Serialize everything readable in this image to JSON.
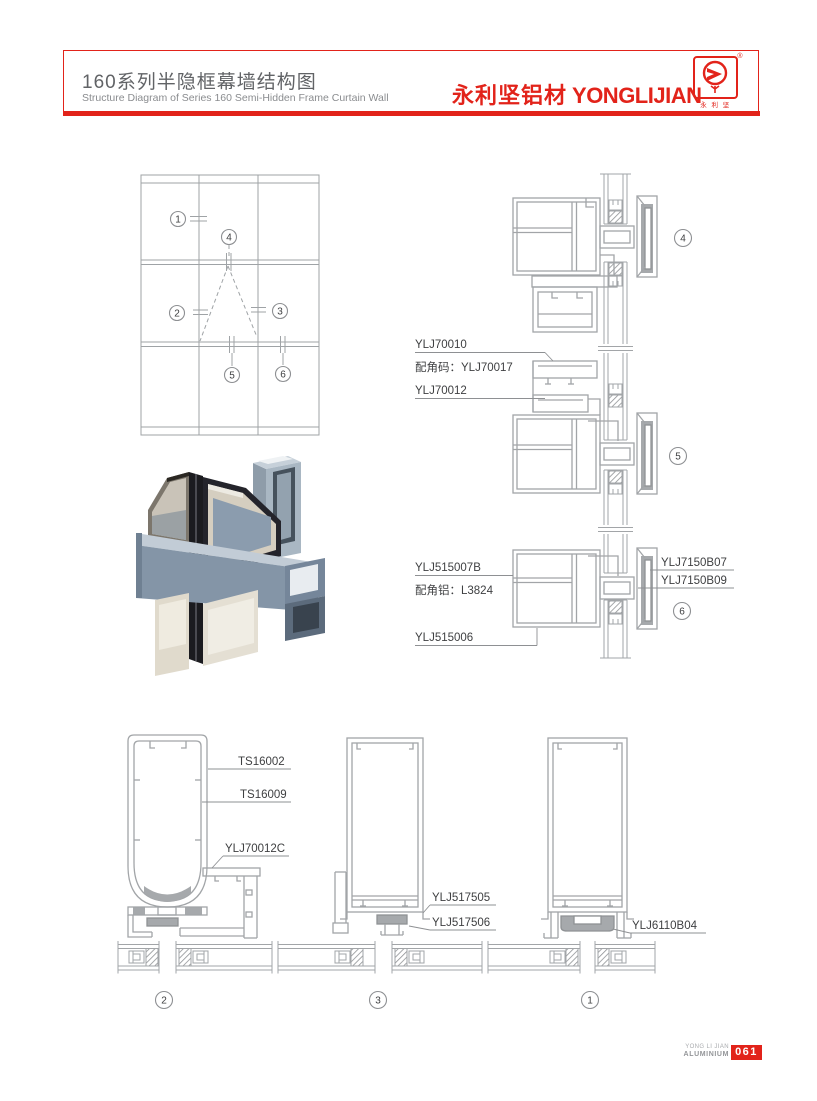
{
  "header": {
    "title_cn": "160系列半隐框幕墙结构图",
    "title_en": "Structure Diagram of Series 160 Semi-Hidden Frame Curtain Wall",
    "brand_cn": "永利坚铝材",
    "brand_en": "YONGLIJIAN",
    "registered_mark": "®",
    "logo_caption": "永 利 坚"
  },
  "callouts": {
    "c1": "1",
    "c2": "2",
    "c3": "3",
    "c4": "4",
    "c5": "5",
    "c6": "6"
  },
  "labels": {
    "ylj70010": "YLJ70010",
    "corner_code_70017": "配角码：YLJ70017",
    "ylj70012": "YLJ70012",
    "ylj515007b": "YLJ515007B",
    "corner_alu_l3824": "配角铝：L3824",
    "ylj515006": "YLJ515006",
    "ylj7150b07": "YLJ7150B07",
    "ylj7150b09": "YLJ7150B09",
    "ts16002": "TS16002",
    "ts16009": "TS16009",
    "ylj70012c": "YLJ70012C",
    "ylj517505": "YLJ517505",
    "ylj517506": "YLJ517506",
    "ylj6110b04": "YLJ6110B04"
  },
  "footer": {
    "brand_line1": "YONG LI JIAN",
    "brand_line2": "ALUMINIUM",
    "page_number": "061"
  },
  "colors": {
    "brand_red": "#E2231A",
    "line_gray": "#A2A5A8",
    "fill_gray": "#A6A9AC",
    "label_dark": "#3F4042"
  }
}
